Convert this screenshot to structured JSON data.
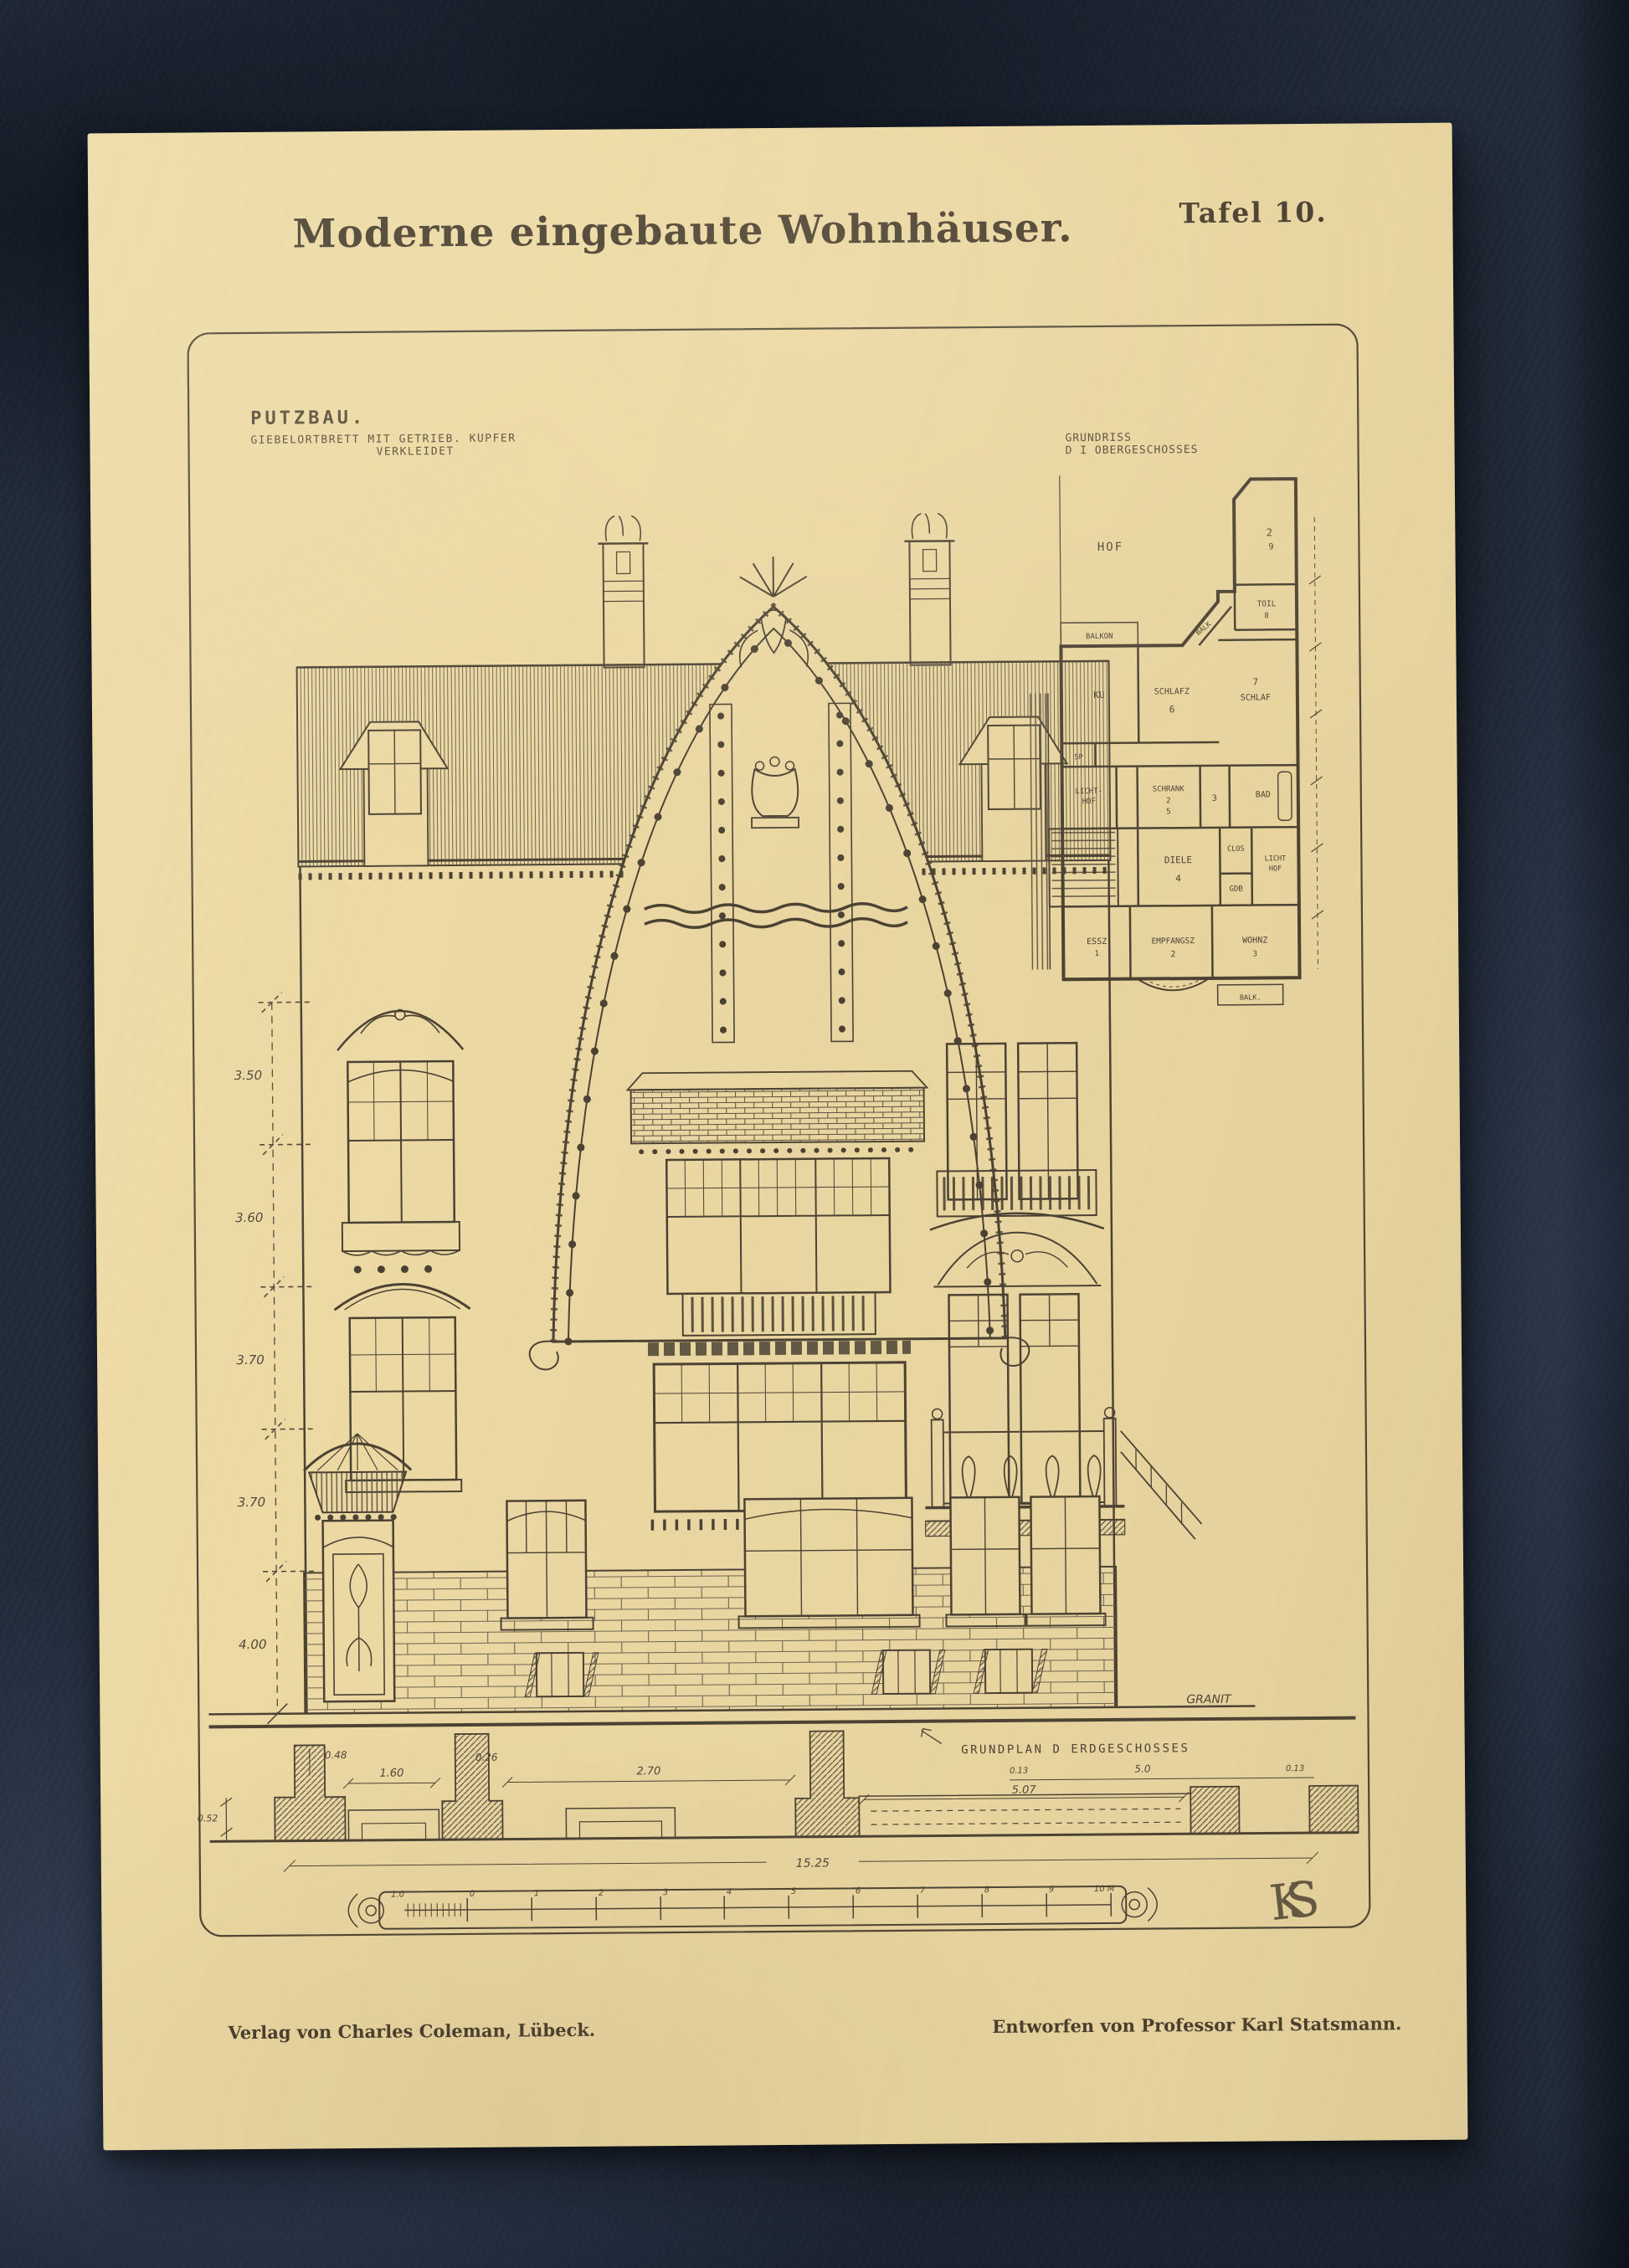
{
  "photo": {
    "fabric_color": "#232c3b",
    "paper_color": "#ecd9a4",
    "ink_color": "#4b4133"
  },
  "plate": {
    "tafel": "Tafel 10.",
    "title": "Moderne eingebaute Wohnhäuser.",
    "putzbau_title": "PUTZBAU.",
    "putzbau_sub1": "GIEBELORTBRETT MIT GETRIEB. KUPFER",
    "putzbau_sub2": "VERKLEIDET",
    "grundriss_1": "GRUNDRISS",
    "grundriss_2": "D I OBERGESCHOSSES",
    "grundplan": "GRUNDPLAN D ERDGESCHOSSES",
    "granit": "GRANIT",
    "monogram": "KS",
    "imprint_publisher": "Verlag von Charles Coleman, Lübeck.",
    "imprint_designer": "Entworfen von Professor Karl Statsmann."
  },
  "plan": {
    "hof": "HOF",
    "balkon": "BALKON",
    "ku": "KU",
    "sp": "SP",
    "schlafz": "SCHLAFZ",
    "schlafz_no": "6",
    "balk": "BALK",
    "toil": "TOIL",
    "toil_no": "8",
    "room2": "2",
    "room2_no": "9",
    "schlaf_no": "7",
    "schlaf": "SCHLAF",
    "lichthof_l1": "LICHT-",
    "lichthof_l2": "HOF",
    "schrank": "SCHRANK",
    "schrank_no": "2",
    "schrank_no2": "5",
    "room3": "3",
    "bad": "BAD",
    "clos": "CLOS",
    "gdb": "GDB",
    "diele": "DIELE",
    "diele_no": "4",
    "lichthof_r1": "LICHT",
    "lichthof_r2": "HOF",
    "essz": "ESSZ",
    "essz_no": "1",
    "empfangsz": "EMPFANGSZ",
    "empfangsz_no": "2",
    "wohnz": "WOHNZ",
    "wohnz_no": "3",
    "balk_s": "BALK."
  },
  "dims": {
    "left": [
      "3.50",
      "3.60",
      "3.70",
      "3.70",
      "4.00"
    ],
    "section": [
      "0.48",
      "1.60",
      "0.26",
      "2.70",
      "5.07"
    ],
    "section_right": [
      "0.13",
      "5.0",
      "0.13"
    ],
    "total": "15.25",
    "height": "0.52"
  },
  "scale": {
    "sub": "1.0",
    "ticks": [
      "0",
      "1",
      "2",
      "3",
      "4",
      "5",
      "6",
      "7",
      "8",
      "9"
    ],
    "end": "10 M"
  }
}
